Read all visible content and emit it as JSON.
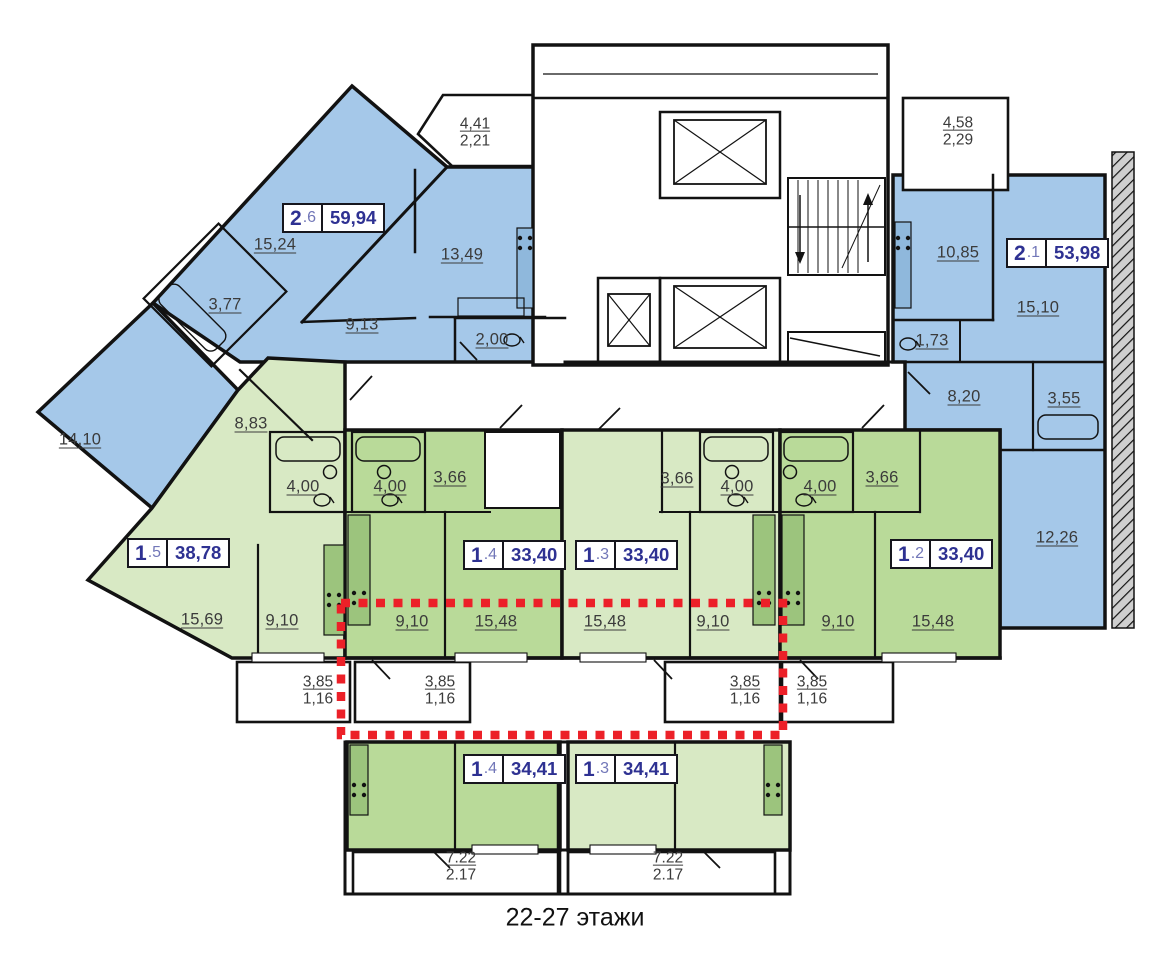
{
  "caption": "22-27 этажи",
  "colors": {
    "blue_fill": "#a5c8e9",
    "green_light": "#d8e9c4",
    "green_dark": "#b9da99",
    "accent_navy": "#2e3192",
    "red_dashed": "#ec2028",
    "wall": "#121212",
    "hatch_gray": "#cfcfcf"
  },
  "apartments": {
    "a26": {
      "type": "2",
      "num": ".6",
      "area": "59,94"
    },
    "a21": {
      "type": "2",
      "num": ".1",
      "area": "53,98"
    },
    "a15": {
      "type": "1",
      "num": ".5",
      "area": "38,78"
    },
    "a14": {
      "type": "1",
      "num": ".4",
      "area": "33,40"
    },
    "a13": {
      "type": "1",
      "num": ".3",
      "area": "33,40"
    },
    "a12": {
      "type": "1",
      "num": ".2",
      "area": "33,40"
    },
    "b14": {
      "type": "1",
      "num": ".4",
      "area": "34,41"
    },
    "b13": {
      "type": "1",
      "num": ".3",
      "area": "34,41"
    }
  },
  "rooms": {
    "r15_24": "15,24",
    "r3_77": "3,77",
    "r9_13": "9,13",
    "r13_49": "13,49",
    "r2_00": "2,00",
    "r14_10": "14,10",
    "r10_85": "10,85",
    "r15_10": "15,10",
    "r1_73": "1,73",
    "r8_20": "8,20",
    "r3_55": "3,55",
    "r12_26": "12,26",
    "r8_83": "8,83",
    "r15_69": "15,69",
    "r4_00": "4,00",
    "r3_66": "3,66",
    "r9_10": "9,10",
    "r15_48": "15,48"
  },
  "balconies": {
    "b441": {
      "a": "4,41",
      "b": "2,21"
    },
    "b458": {
      "a": "4,58",
      "b": "2,29"
    },
    "b385": {
      "a": "3,85",
      "b": "1,16"
    },
    "b722": {
      "a": "7.22",
      "b": "2.17"
    }
  }
}
